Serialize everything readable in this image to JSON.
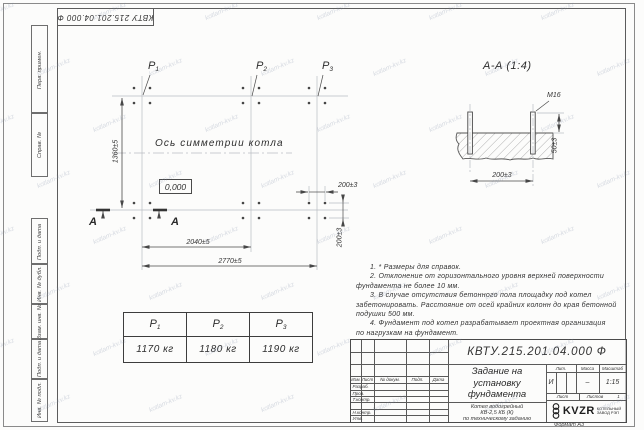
{
  "sheet": {
    "stamp_top": "КВТУ 215.201.04.000 Ф",
    "format_label": "Формат А3",
    "watermark": "kotlam-kv.kz"
  },
  "frame_labels": [
    "Перв. примен.",
    "Справ. №",
    "Подп. и дата",
    "Инв. № дубл.",
    "Взам. инв. №",
    "Подп. и дата",
    "Инв. № подл."
  ],
  "plan": {
    "loads": [
      {
        "base": "P",
        "sub": "1"
      },
      {
        "base": "P",
        "sub": "2"
      },
      {
        "base": "P",
        "sub": "3"
      }
    ],
    "axis_label": "Ось симметрии котла",
    "elevation": "0,000",
    "dims": {
      "height": "1360±5",
      "span_mid": "2040±5",
      "span_full": "2770±5",
      "bolt_h": "200±3",
      "bolt_v": "200±3"
    },
    "section_letter": "А"
  },
  "section": {
    "title": "А-А (1:4)",
    "bolt_thread": "М16",
    "dims": {
      "protrusion": "50±3",
      "spacing": "200±3"
    }
  },
  "notes": [
    {
      "lines": [
        "1. * Размеры для справок."
      ]
    },
    {
      "lines": [
        "2. Отклонение от горизонтального уровня верхней поверхности",
        "фундамента не более 10 мм."
      ]
    },
    {
      "lines": [
        "3. В случае отсутствия бетонного пола площадку под котел",
        "забетонировать. Расстояние от осей крайних колонн до края бетонной",
        "подушки 500 мм."
      ]
    },
    {
      "lines": [
        "4. Фундамент под котел разрабатывает проектная организация",
        "по нагрузкам на фундамент."
      ]
    }
  ],
  "load_table": {
    "headers": [
      {
        "base": "P",
        "sub": "1"
      },
      {
        "base": "P",
        "sub": "2"
      },
      {
        "base": "P",
        "sub": "3"
      }
    ],
    "values": [
      "1170 кг",
      "1180 кг",
      "1190 кг"
    ]
  },
  "title_block": {
    "doc_number": "КВТУ.215.201.04.000  Ф",
    "title_lines": [
      "Задание на",
      "установку",
      "фундамента"
    ],
    "product_lines": [
      "Котел водогрейный",
      "КВ-2,5 КБ (К)",
      "по техническому заданию"
    ],
    "header_cols": [
      "Изм.",
      "Лист",
      "№ докум.",
      "Подп.",
      "Дата"
    ],
    "roles": [
      "Разраб.",
      "Пров.",
      "Т.контр.",
      "Н.контр.",
      "Утв."
    ],
    "lit_label": "Лит.",
    "lit_value": "И",
    "mass_label": "Масса",
    "mass_value": "–",
    "scale_label": "Масштаб",
    "scale_value": "1:15",
    "sheet_label": "Лист",
    "sheets_label": "Листов",
    "sheets_value": "1",
    "logo_text": "KVZR",
    "logo_caption_lines": [
      "КОТЕЛЬНЫЙ",
      "ЗАВОД РЭП"
    ]
  }
}
